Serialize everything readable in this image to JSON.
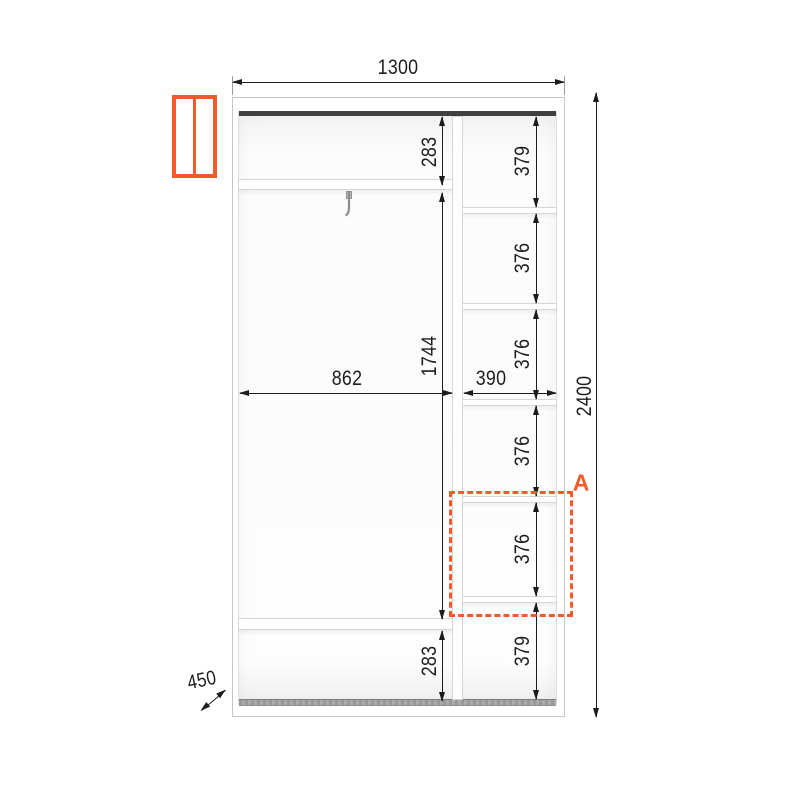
{
  "title": "Wardrobe interior dimensions drawing",
  "accent_color": "#F15A29",
  "icon": {
    "name": "two-door-wardrobe-icon"
  },
  "overall": {
    "width": "1300",
    "height": "2400",
    "depth": "450"
  },
  "left_section": {
    "width": "862",
    "top_gap": "283",
    "middle_gap": "1744",
    "bottom_gap": "283"
  },
  "right_section": {
    "width": "390",
    "cells": [
      "379",
      "376",
      "376",
      "376",
      "376",
      "379"
    ]
  },
  "region": {
    "label": "A"
  }
}
